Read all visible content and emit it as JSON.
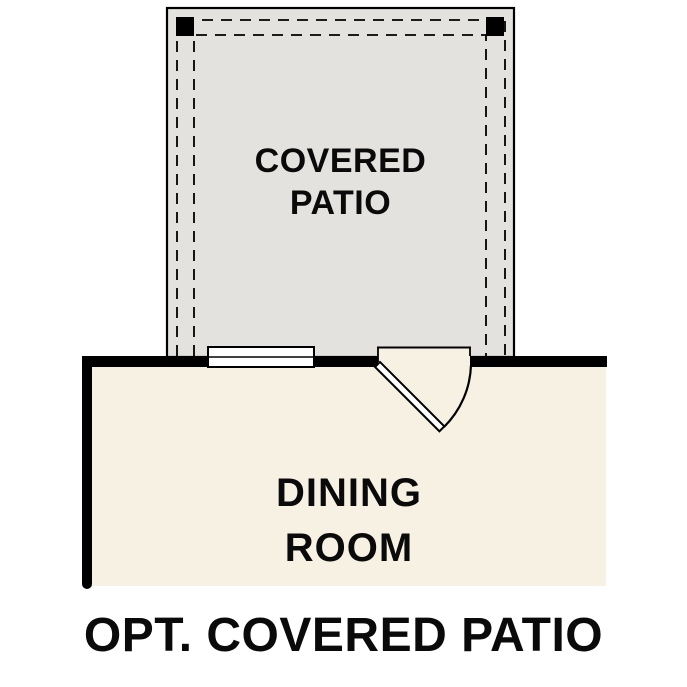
{
  "caption": "OPT. COVERED PATIO",
  "rooms": {
    "patio": {
      "label": "COVERED\nPATIO"
    },
    "dining": {
      "label": "DINING\nROOM"
    }
  },
  "colors": {
    "background": "#ffffff",
    "patio_fill": "#e3e2df",
    "dining_fill": "#f7f1e4",
    "wall": "#000000",
    "symbol_fill": "#ffffff",
    "text": "#0a0a0a"
  }
}
